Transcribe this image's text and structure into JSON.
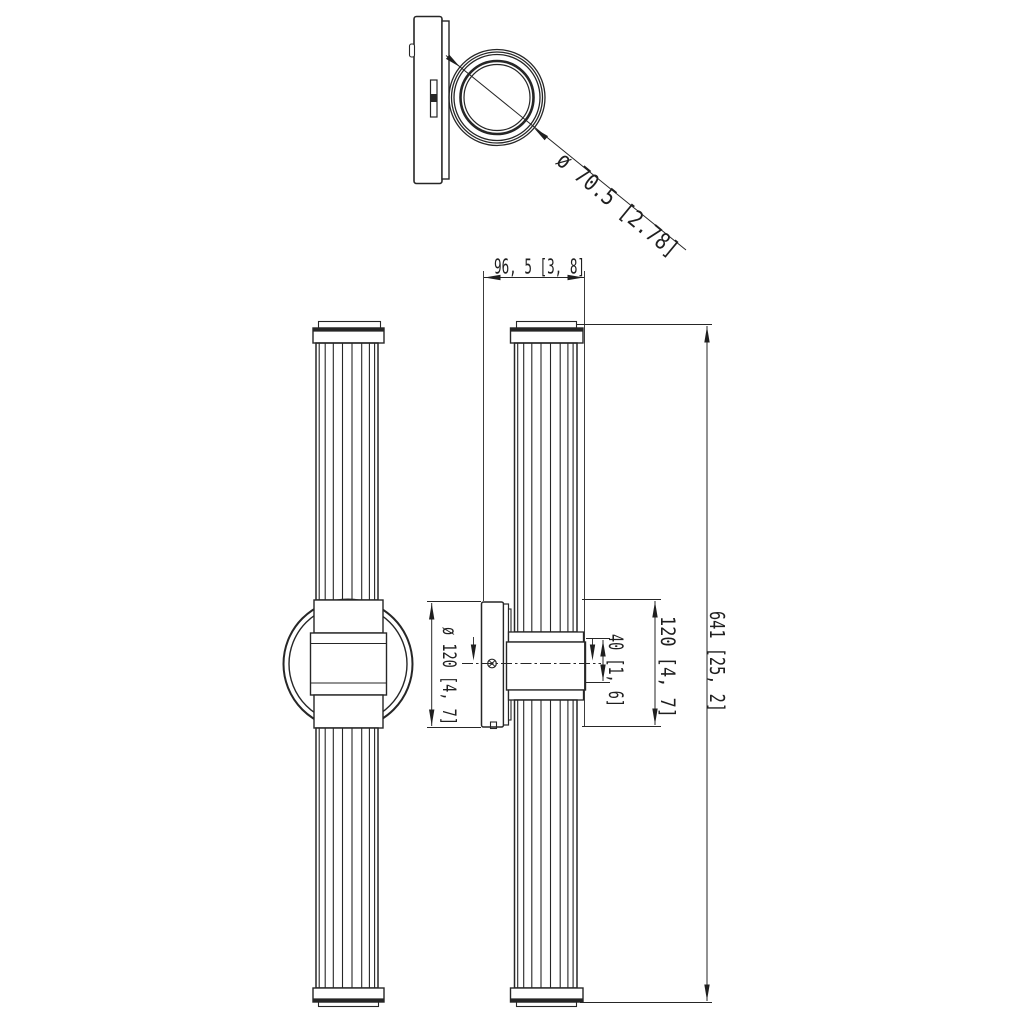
{
  "drawing": {
    "ink_color": "#262626",
    "background_color": "#ffffff",
    "dimensions": {
      "ring_diameter": "ø 70.5 [2.78]",
      "fixture_depth": "96, 5  [3, 8]",
      "backplate_diameter": "ø 120 [4, 7]",
      "center_body_width": "40 [1, 6]",
      "center_body_height": "120 [4, 7]",
      "overall_height": "641 [25, 2]"
    }
  }
}
